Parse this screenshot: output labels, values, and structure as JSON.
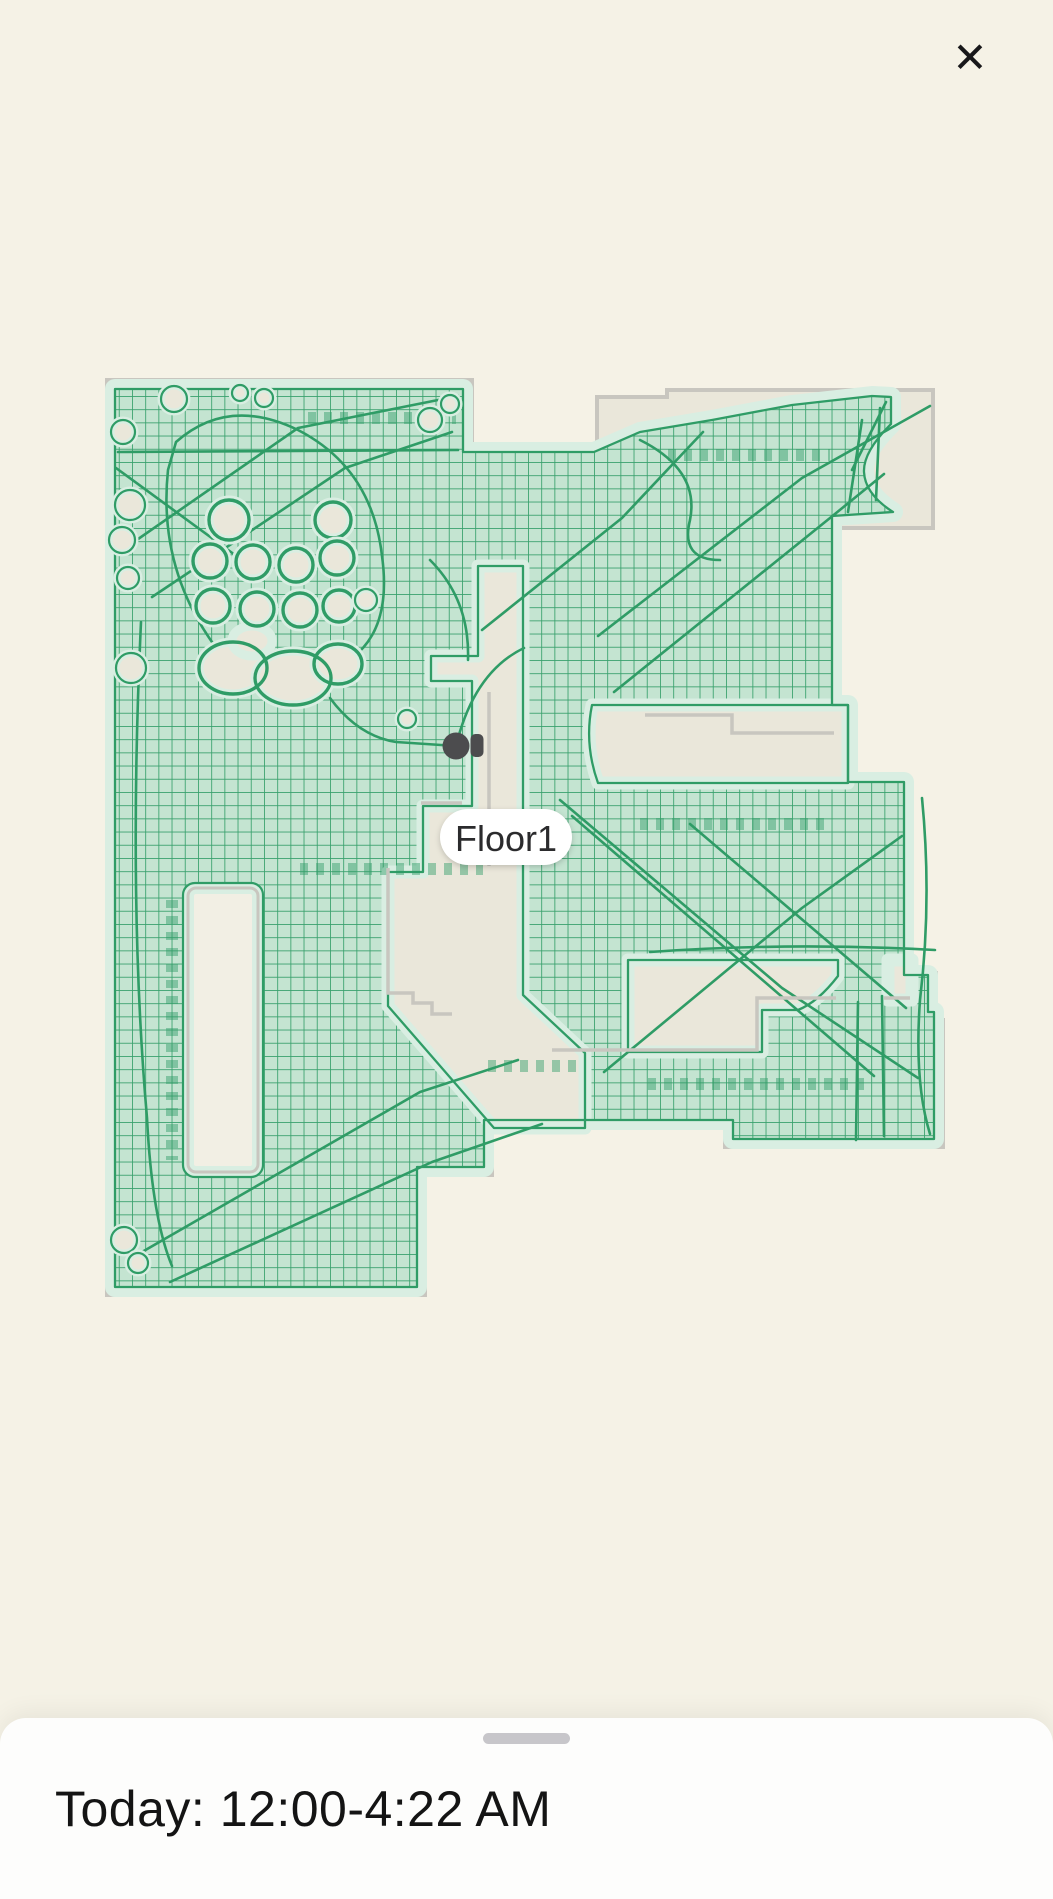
{
  "overlay": {
    "close_icon": "✕"
  },
  "map": {
    "floor_label": "Floor1"
  },
  "sheet": {
    "title": "Today: 12:00-4:22 AM"
  },
  "colors": {
    "bg": "#f5f2e6",
    "floor": "#eae7da",
    "wall": "#c8c6bf",
    "clean": "#c4e4d1",
    "halo": "#d9eee2",
    "green": "#2f9c66",
    "couch": "#f2efe4",
    "robot": "#4c4c4e",
    "pill_bg": "#ffffff",
    "pill_text": "#2b2b2d",
    "sheet": "#fdfdfc",
    "handle": "#c7c6ca",
    "title": "#141414",
    "close": "#18181a"
  }
}
